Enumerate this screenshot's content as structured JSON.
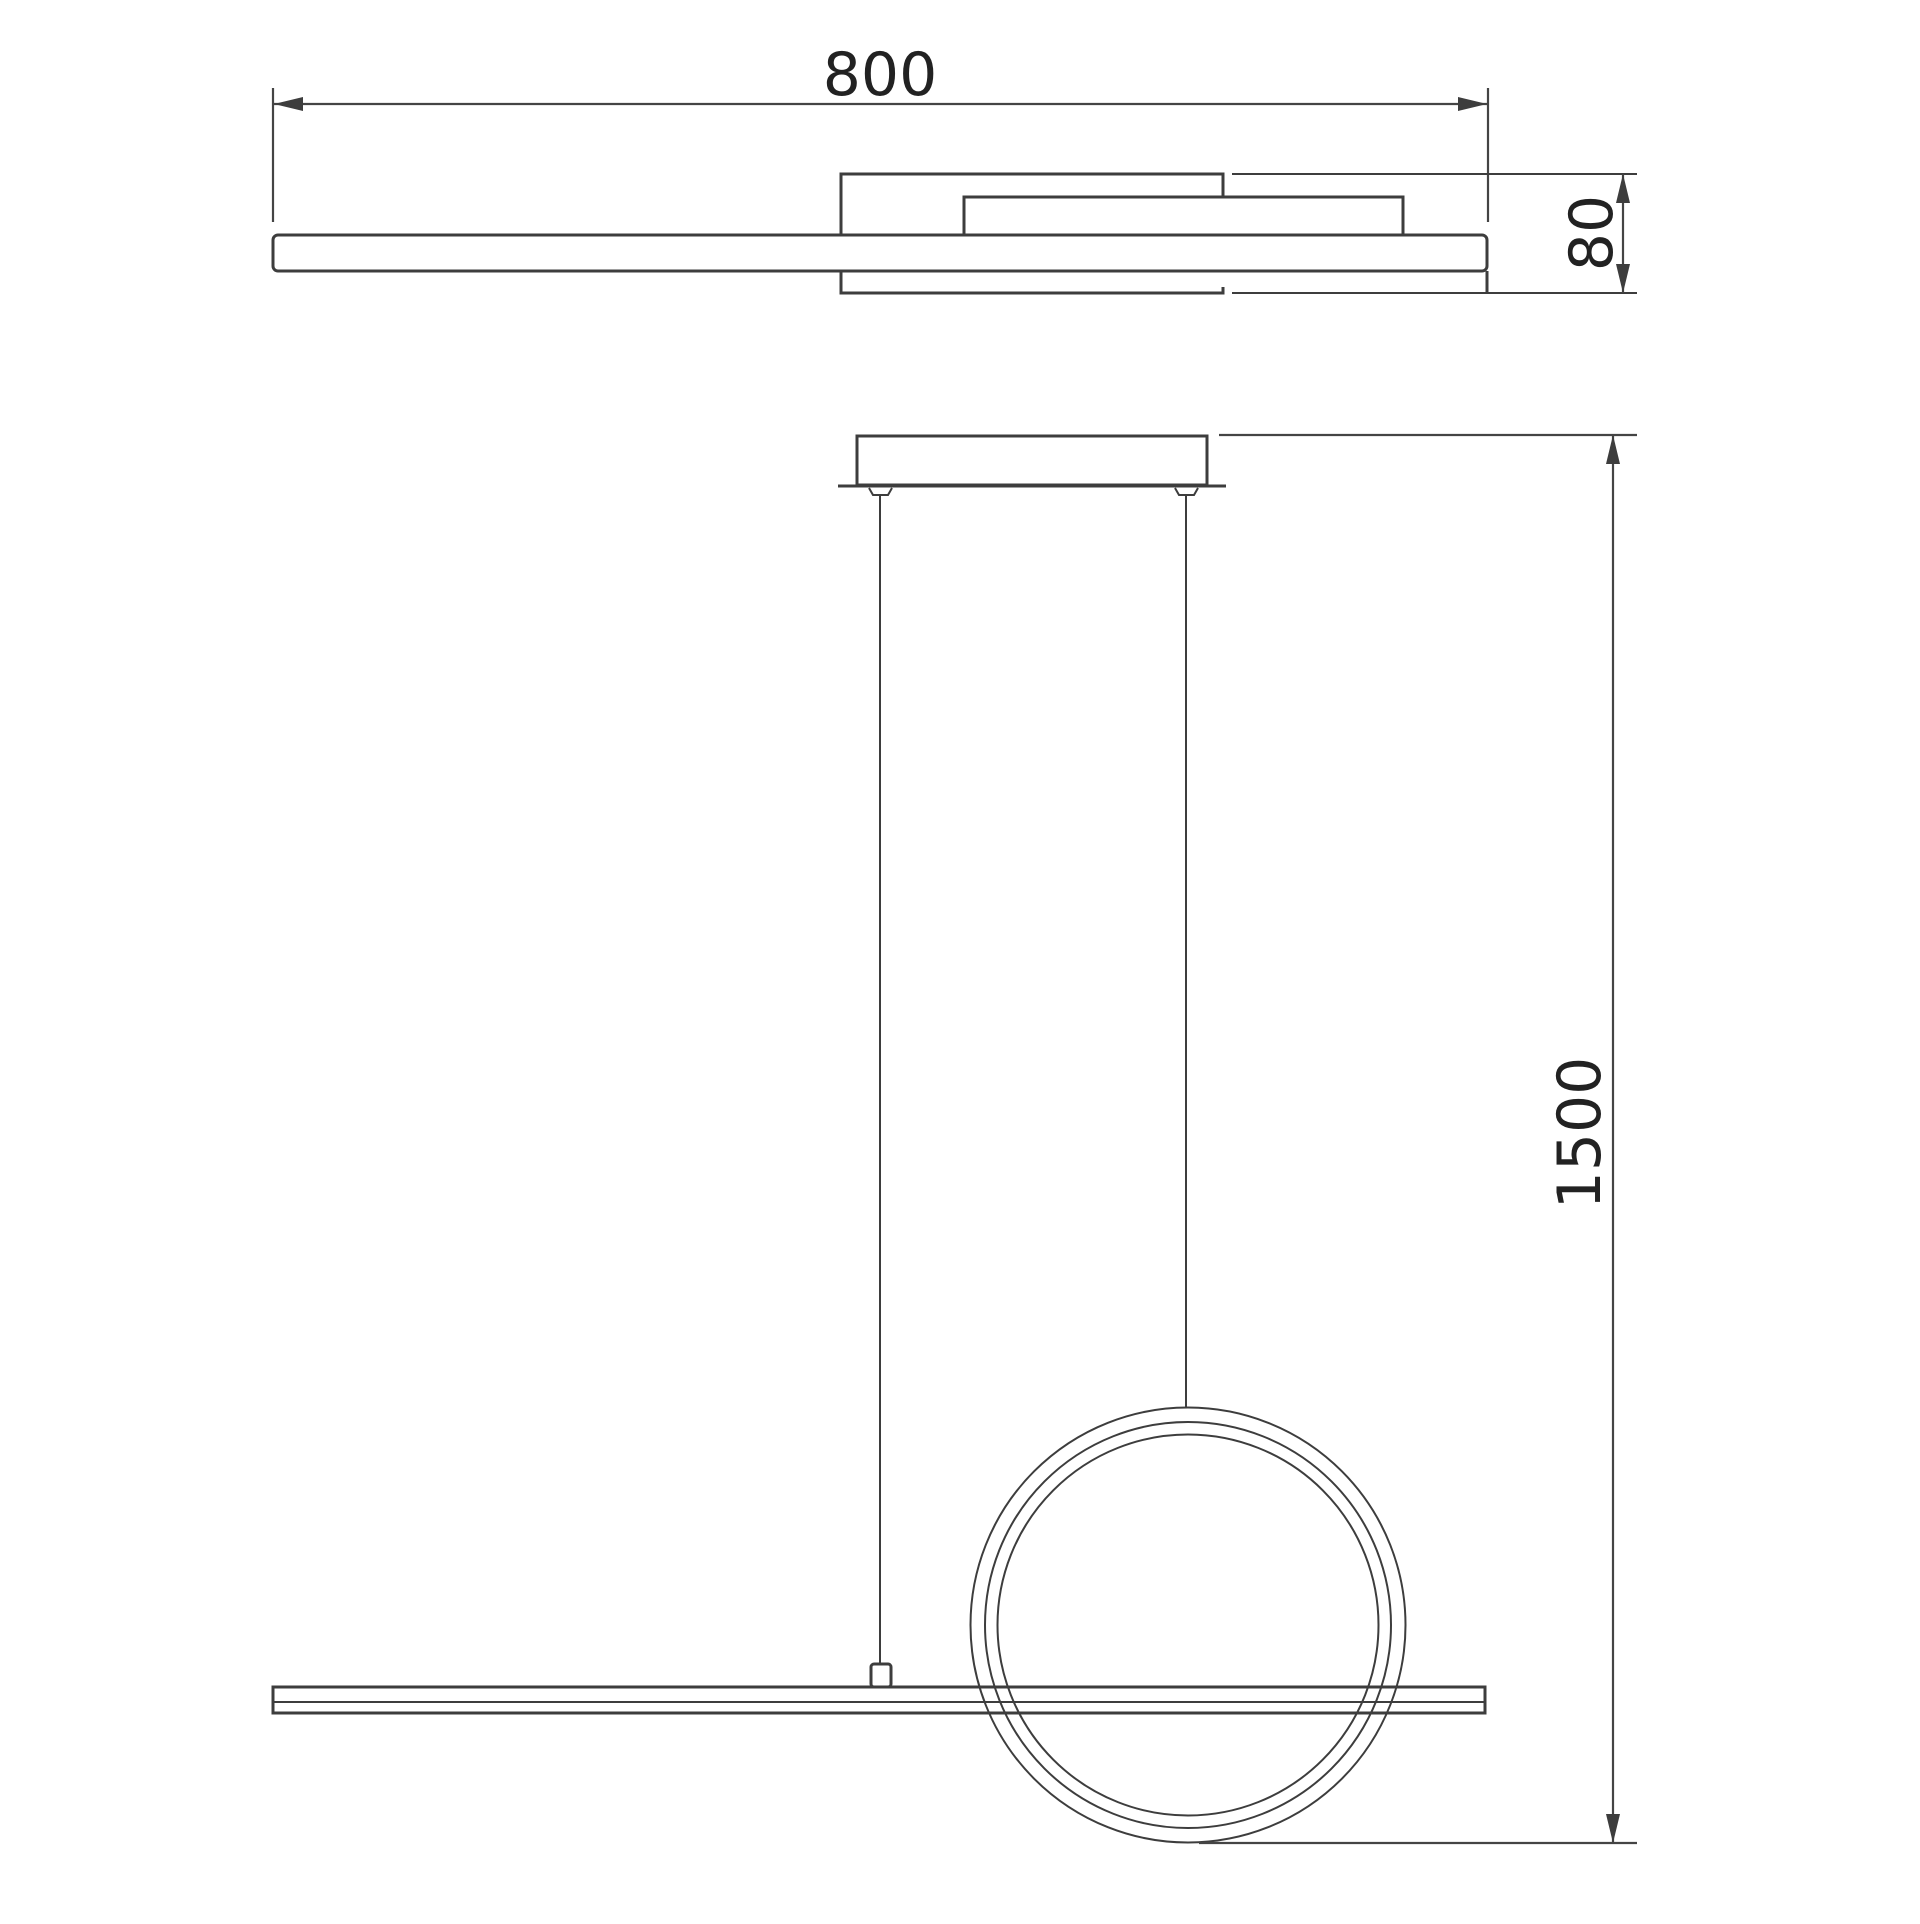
{
  "drawing": {
    "background_color": "#ffffff",
    "line_color": "#3d3d3d",
    "text_color": "#222222",
    "top_view": {
      "width_label": "800",
      "depth_label": "80"
    },
    "front_view": {
      "drop_label": "1500"
    }
  }
}
